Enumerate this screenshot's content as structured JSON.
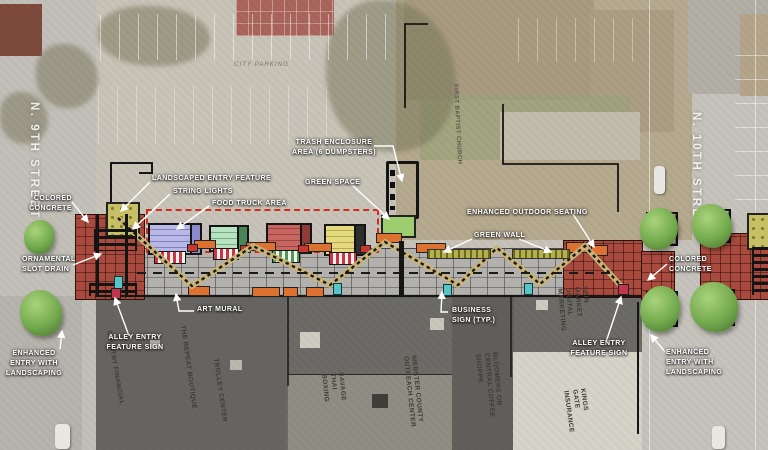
{
  "plan": {
    "title": "Alley activation site plan",
    "streets": {
      "left": "N. 9TH STREET",
      "right": "N. 10TH STREET"
    },
    "areas": {
      "city_parking": "CITY PARKING",
      "church": "FIRST BAPTIST CHURCH"
    },
    "callouts": {
      "colored_concrete_left": "COLORED CONCRETE",
      "landscaped_entry_feature": "LANDSCAPED ENTRY FEATURE",
      "string_lights": "STRING LIGHTS",
      "food_truck_area": "FOOD TRUCK AREA",
      "trash_enclosure": "TRASH ENCLOSURE AREA (6 DUMPSTERS)",
      "green_space": "GREEN SPACE",
      "enhanced_outdoor_seating": "ENHANCED OUTDOOR SEATING",
      "green_wall": "GREEN WALL",
      "ornamental_slot_drain": "ORNAMENTAL SLOT DRAIN",
      "art_mural": "ART MURAL",
      "business_sign_typ": "BUSINESS SIGN (TYP.)",
      "alley_entry_feature_sign_left": "ALLEY ENTRY FEATURE SIGN",
      "alley_entry_feature_sign_right": "ALLEY ENTRY FEATURE SIGN",
      "enhanced_entry_landscaping_left": "ENHANCED ENTRY WITH LANDSCAPING",
      "enhanced_entry_landscaping_right": "ENHANCED ENTRY WITH LANDSCAPING",
      "colored_concrete_right": "COLORED CONCRETE"
    },
    "businesses": {
      "country_financial": "COUNTRY FINANCIAL",
      "repeat_boutique": "THE REPEAT BOUTIQUE",
      "trolley_center": "TROLLEY CENTER",
      "savage_thai": "SAVAGE THAI BOXING",
      "webster_county": "WEBSTER COUNTY OUTREACH CENTER",
      "bloomers": "BLOOMERS ON CENTRAL COFFEE SHOPPE",
      "spin_market": "SPIN MARKET DIGITAL MARKETING",
      "kings_gate": "KINGS GATE INSURANCE"
    },
    "legend_colors": {
      "colored_concrete": "#A84B3E",
      "food_truck_outline": "#D42B1E",
      "green_space": "#9CCD6E",
      "green_wall": "#B3B04D",
      "seating_orange": "#DD7230",
      "business_sign_teal": "#58C4C8",
      "entry_sign_red": "#C2334D",
      "tree_green": "#74AA4E",
      "string_lights": "#1A1A1A"
    }
  }
}
